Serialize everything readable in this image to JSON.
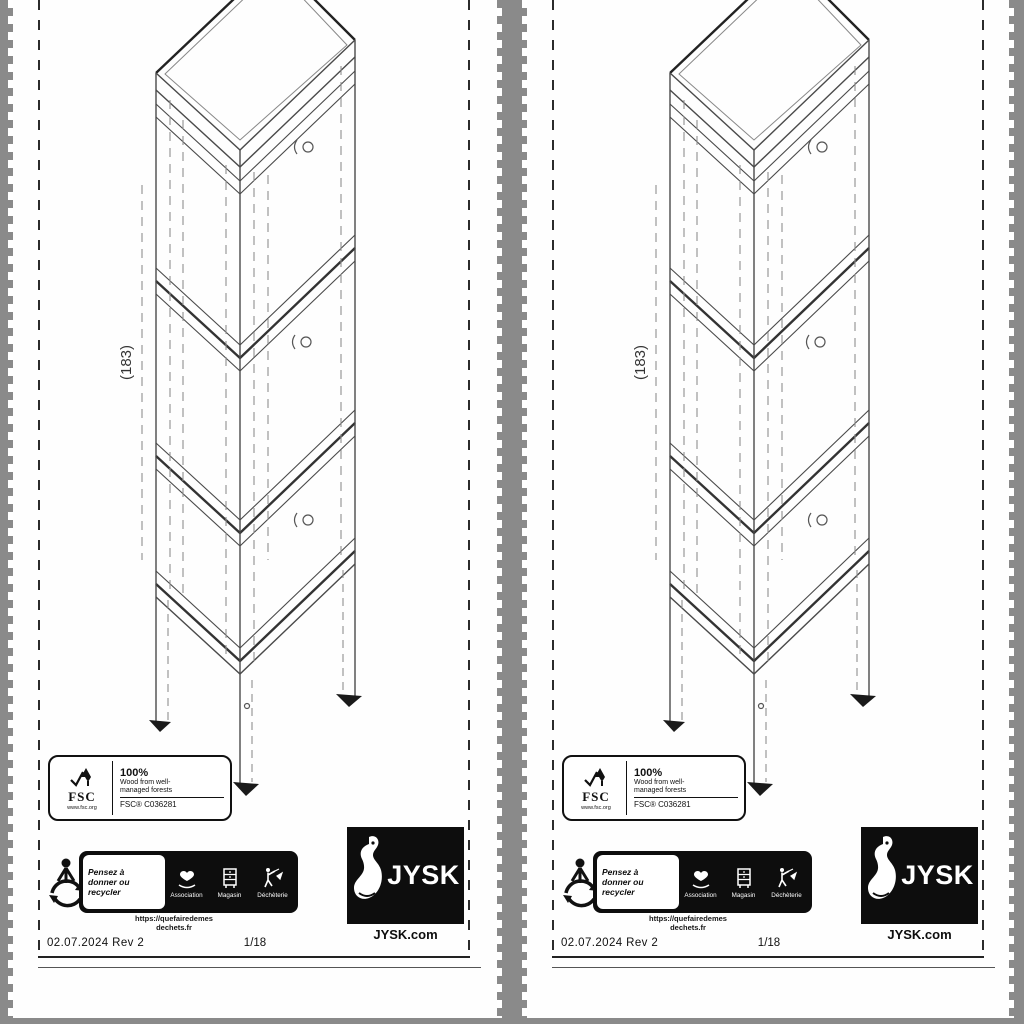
{
  "colors": {
    "binding_gray": "#8a8a8a",
    "banner_black": "#0d0d0d",
    "drawing_line": "#4a4a4a"
  },
  "page": {
    "drawing": {
      "dimension_label": "(183)"
    },
    "fsc_label": {
      "logo": "FSC",
      "logo_url": "www.fsc.org",
      "percent": "100%",
      "desc_line1": "Wood from well-",
      "desc_line2": "managed forests",
      "cert_code": "FSC® C036281"
    },
    "recycling": {
      "headline_line1": "Pensez à",
      "headline_line2": "donner ou recycler",
      "channels": [
        {
          "label": "Association"
        },
        {
          "label": "Magasin"
        },
        {
          "label": "Déchèterie"
        }
      ],
      "url_line1": "https://quefairedemes",
      "url_line2": "dechets.fr"
    },
    "brand": {
      "name": "JYSK",
      "website": "JYSK.com"
    },
    "footer": {
      "revision": "02.07.2024 Rev 2",
      "page_number": "1/18"
    }
  }
}
